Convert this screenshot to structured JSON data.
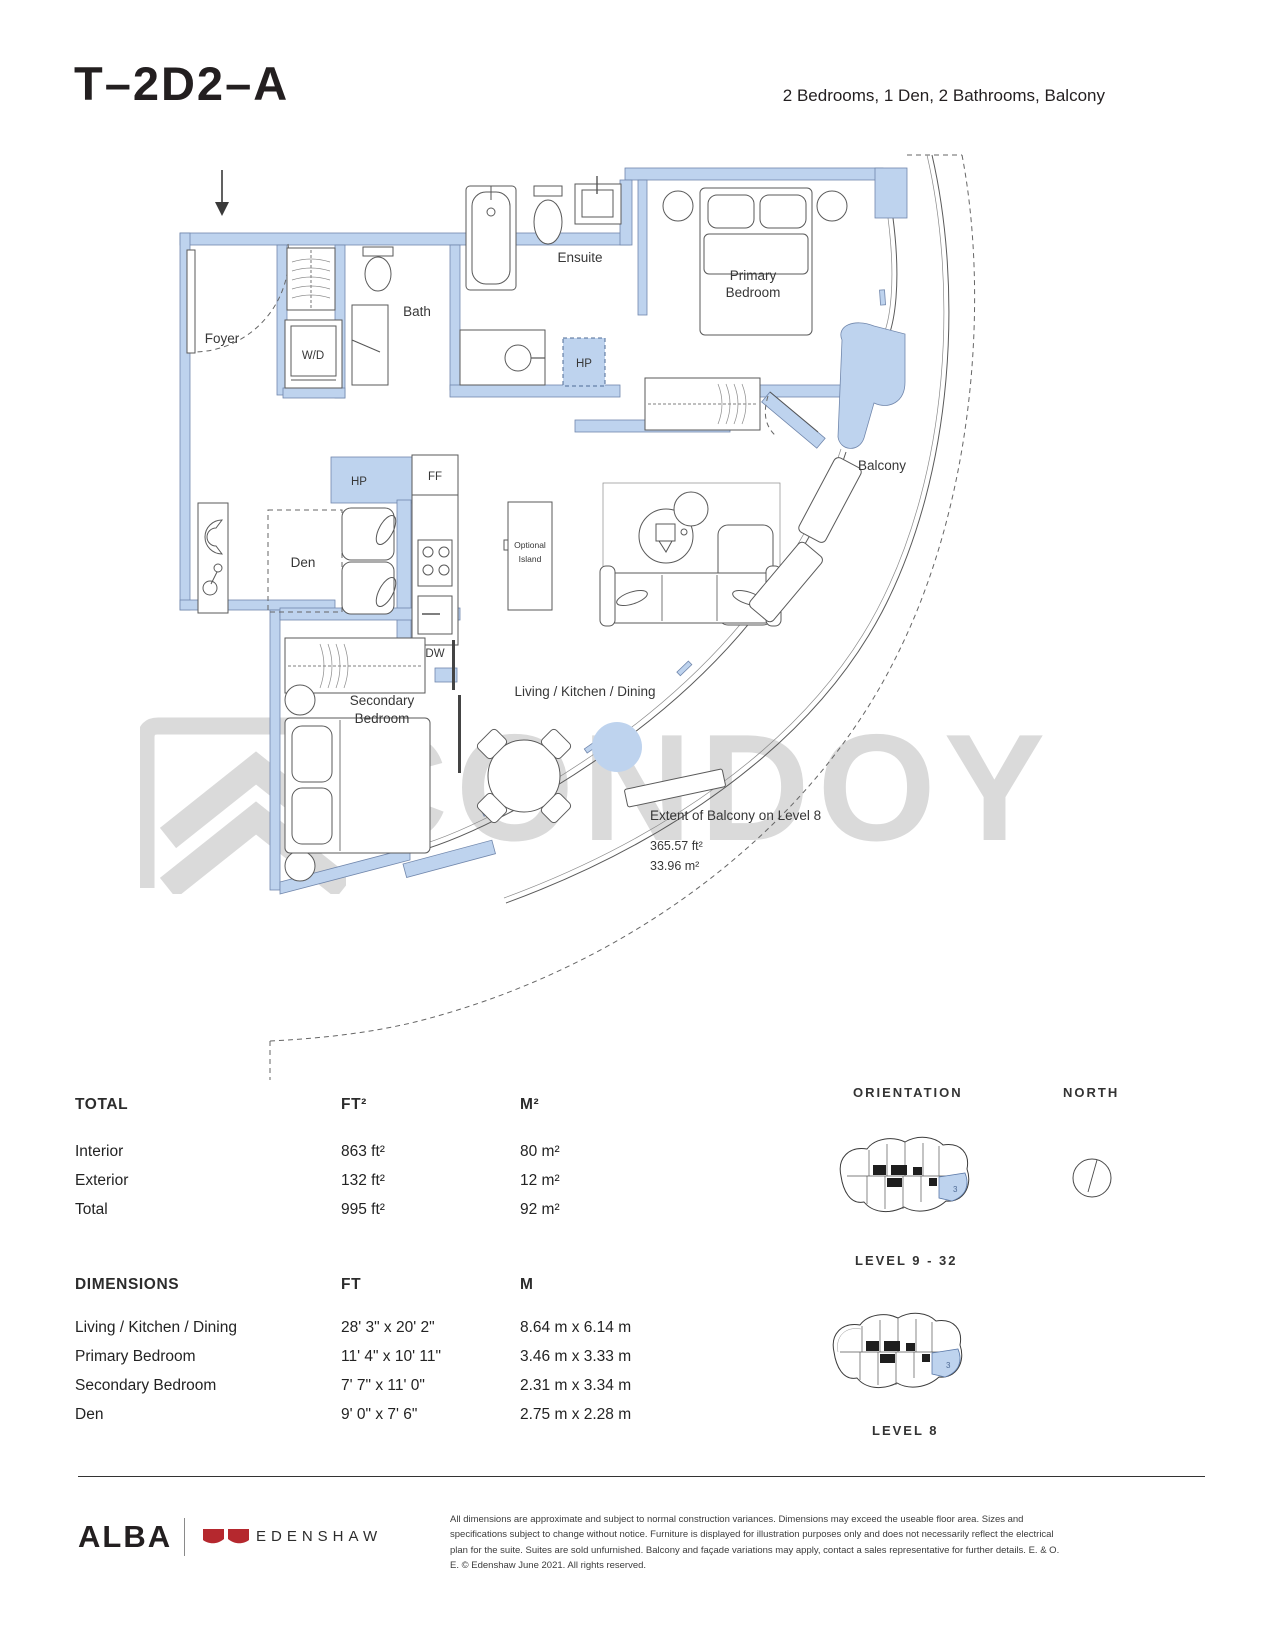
{
  "header": {
    "plan_code": "T–2D2–A",
    "summary": "2 Bedrooms, 1 Den, 2 Bathrooms, Balcony"
  },
  "watermark": {
    "text": "CONDOY"
  },
  "plan": {
    "rooms": {
      "foyer": "Foyer",
      "wd": "W/D",
      "bath": "Bath",
      "ensuite": "Ensuite",
      "hp": "HP",
      "ff": "FF",
      "dw": "DW",
      "den": "Den",
      "primary_bedroom": [
        "Primary",
        "Bedroom"
      ],
      "secondary_bedroom": [
        "Secondary",
        "Bedroom"
      ],
      "optional_island": [
        "Optional",
        "Island"
      ],
      "living": "Living / Kitchen / Dining",
      "balcony": "Balcony"
    },
    "balcony_extent": {
      "title": "Extent of Balcony on Level 8",
      "area_ft": "365.57 ft²",
      "area_m": "33.96 m²"
    }
  },
  "totals": {
    "title": "TOTAL",
    "col_ft": "FT²",
    "col_m": "M²",
    "rows": [
      {
        "label": "Interior",
        "ft": "863 ft²",
        "m": "80 m²"
      },
      {
        "label": "Exterior",
        "ft": "132 ft²",
        "m": "12 m²"
      },
      {
        "label": "Total",
        "ft": "995 ft²",
        "m": "92 m²"
      }
    ]
  },
  "dimensions": {
    "title": "DIMENSIONS",
    "col_ft": "FT",
    "col_m": "M",
    "rows": [
      {
        "label": "Living / Kitchen / Dining",
        "ft": "28' 3\" x 20' 2\"",
        "m": "8.64 m x 6.14 m"
      },
      {
        "label": "Primary Bedroom",
        "ft": "11' 4\" x 10' 11\"",
        "m": "3.46 m x 3.33 m"
      },
      {
        "label": "Secondary Bedroom",
        "ft": "7' 7\" x 11' 0\"",
        "m": "2.31 m x 3.34 m"
      },
      {
        "label": "Den",
        "ft": "9' 0\" x 7' 6\"",
        "m": "2.75 m x 2.28 m"
      }
    ]
  },
  "keyplans": {
    "orientation_label": "ORIENTATION",
    "north_label": "NORTH",
    "upper_caption": "LEVEL 9 - 32",
    "lower_caption": "LEVEL 8",
    "unit_number": "3"
  },
  "footer": {
    "brand": "ALBA",
    "developer": "EDENSHAW",
    "disclaimer": "All dimensions are approximate and subject to normal construction variances. Dimensions may exceed the useable floor area. Sizes and specifications subject to change without notice. Furniture is displayed for illustration purposes only and does not necessarily reflect the electrical plan for the suite. Suites are sold unfurnished. Balcony and façade variations may apply, contact a sales representative for further details. E. & O. E. © Edenshaw June 2021. All rights reserved."
  },
  "colors": {
    "wall_fill": "#bed3ee",
    "wall_stroke": "#7187ac",
    "accent_red": "#b5282e",
    "watermark_gray": "#dadada"
  }
}
